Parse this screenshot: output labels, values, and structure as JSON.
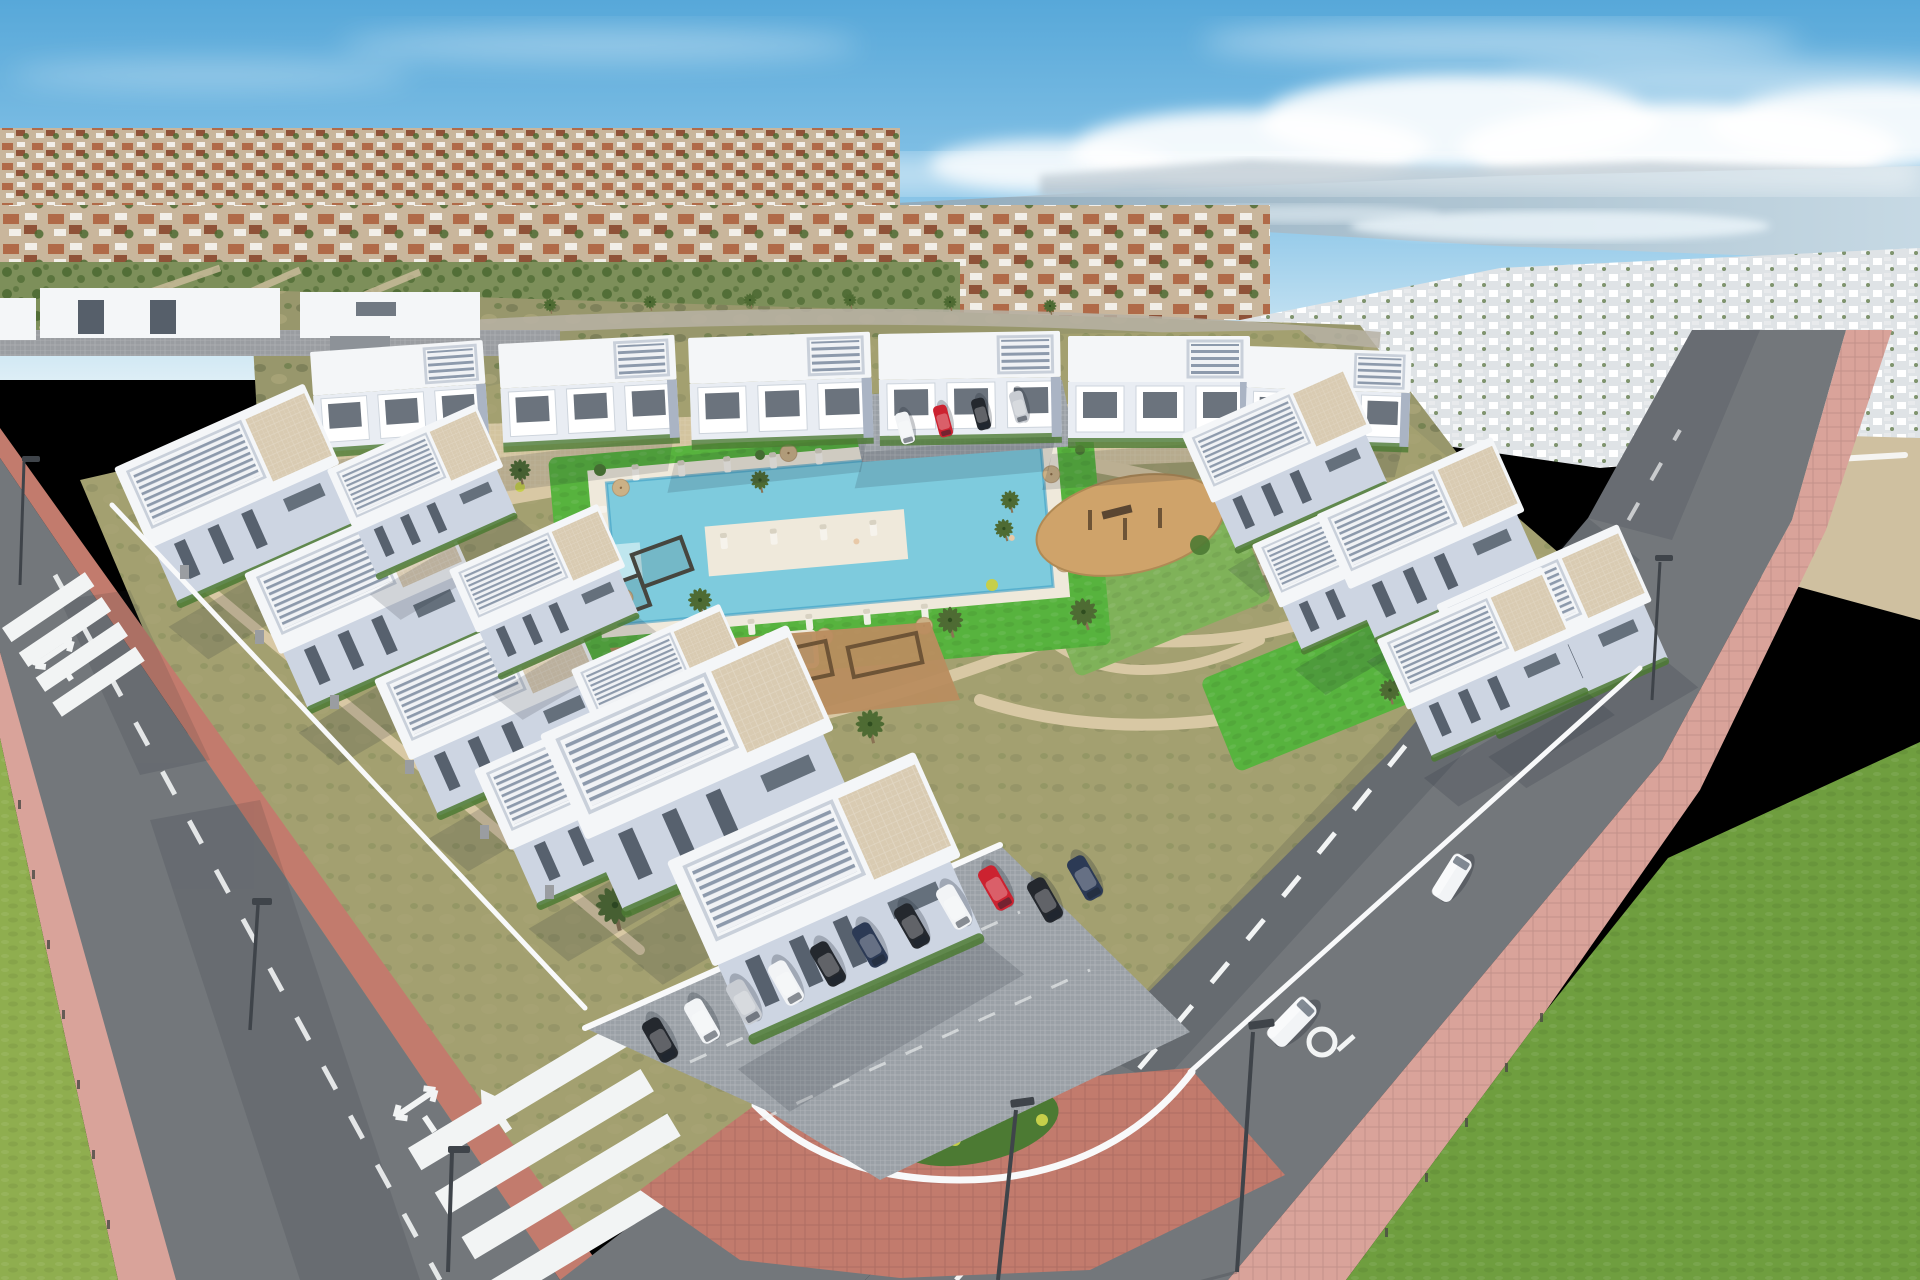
{
  "scene": {
    "type": "aerial-photograph",
    "setting": "Aerial drone view of a modern white apartment complex with central pool garden, perimeter roads, parking and a distant lagoon",
    "description": "New-build residential development of cubic white apartment blocks with louvered rooftop pergolas arranged around a landscaped garden with an L-shaped swimming pool, sun loungers, parasols, palm trees and playgrounds. Perimeter roads with zebra crossings, lane arrows and pink paved sidewalks surround the walled site. A suburb with terracotta roofs, green scrubland and a large lagoon stretch to the horizon under a blue sky with a low cloud bank.",
    "time_of_day": "day",
    "sky_conditions": "blue sky, low bright cloud bank over the lagoon, light haze at the horizon"
  },
  "palette": {
    "sky_top": "#57a8d9",
    "sky_mid": "#8cc6e8",
    "sky_horizon": "#ddeef6",
    "cloud": "#ffffff",
    "water_far": "#8fa9ba",
    "water_near": "#c6d9e4",
    "water_sparkle": "#edf6fb",
    "hills": "#97aab8",
    "town_base": "#c9b69c",
    "roof_terracotta": "#b06a48",
    "roof_dark": "#8f5238",
    "town_white": "#f2efe9",
    "tree_green": "#4e6b33",
    "park_green": "#7d8f5a",
    "scrub_base": "#98976c",
    "scrub_dark": "#6f7550",
    "scrub_light": "#b3ac7e",
    "dirt_sand": "#cfc0a0",
    "field_green": "#8fae4f",
    "grass_verge": "#6f9e3f",
    "lawn_bright": "#57b33e",
    "lawn_mid": "#7fb259",
    "garden_base": "#a3a070",
    "path_beige": "#d8c8a4",
    "pool_water": "#7ecbdd",
    "pool_deep": "#3e9ec4",
    "pool_deck": "#efe9db",
    "building_white": "#f4f6f8",
    "facade_light": "#cdd5e2",
    "facade_front": "#e9edf3",
    "building_shade": "#aab4c4",
    "window_dark": "#394451",
    "pergola_slat": "#8d9aac",
    "terrace_beige": "#d9cbb2",
    "hedge_green": "#4c7a33",
    "bush_yellow": "#c6cf4a",
    "wall_white": "#f8f9fa",
    "stone_grey": "#9a9da1",
    "road_asphalt": "#73777b",
    "road_dark": "#5f6367",
    "marking_white": "#f2f4f4",
    "sidewalk_pink": "#d9a39a",
    "sidewalk_red": "#c27b6d",
    "pavers_grey": "#9aa0a6",
    "playground_sand": "#cfa36a",
    "playground_dirt": "#b98d5f",
    "wood_brown": "#6e5436",
    "umbrella_tan": "#cbb186",
    "lounger_white": "#f6f3ec",
    "palm_trunk": "#8a7354",
    "lamp_grey": "#3f444a",
    "car_red": "#cc2230",
    "car_white": "#f2f4f6",
    "car_black": "#24282e",
    "car_silver": "#c8ccd2",
    "car_blue": "#2c3a55"
  },
  "objects": {
    "pool": {
      "shape": "L-shaped pool with island deck, steps and separate jacuzzi",
      "sun_loungers": 22,
      "parasols": 9
    },
    "playgrounds": [
      "sand playground with climbing frame and slide",
      "dirt calisthenics area with wooden frames"
    ],
    "parked_cars_main_lot": [
      "black",
      "white",
      "silver",
      "white",
      "black",
      "dark-blue",
      "black",
      "white",
      "red",
      "black",
      "dark-blue"
    ],
    "parked_cars_upper_lot": [
      "white",
      "red",
      "black",
      "silver"
    ],
    "moving_vehicles": [
      {
        "type": "mpv",
        "color": "white",
        "location": "right road"
      },
      {
        "type": "van",
        "color": "white",
        "location": "upper right road"
      }
    ],
    "road_markings": [
      "zebra crosswalk left road",
      "zebra crosswalk bottom road",
      "dashed lane lines",
      "straight arrows",
      "left-right combo arrows",
      "circle symbol"
    ],
    "street_lamps": 6,
    "crosswalks": 2,
    "palm_trees": 26,
    "perimeter": "white wall with stone gabion pillars and curved corner planter with palm and yellow shrubs"
  }
}
